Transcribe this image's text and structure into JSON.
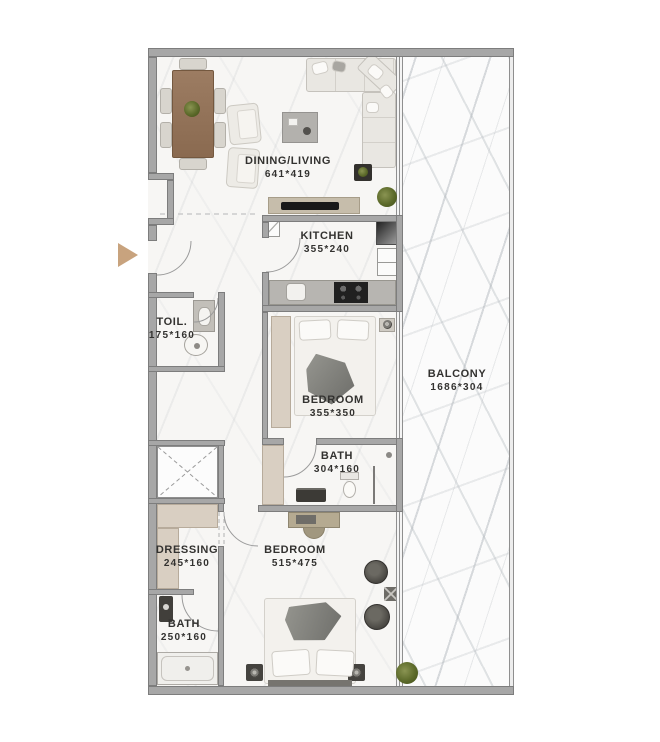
{
  "plan": {
    "rooms": [
      {
        "id": "dining-living",
        "label": "DINING/LIVING",
        "dims": "641*419"
      },
      {
        "id": "kitchen",
        "label": "KITCHEN",
        "dims": "355*240"
      },
      {
        "id": "toilet",
        "label": "TOIL.",
        "dims": "175*160"
      },
      {
        "id": "bedroom-1",
        "label": "BEDROOM",
        "dims": "355*350"
      },
      {
        "id": "balcony",
        "label": "BALCONY",
        "dims": "1686*304"
      },
      {
        "id": "bath-1",
        "label": "BATH",
        "dims": "304*160"
      },
      {
        "id": "dressing",
        "label": "DRESSING",
        "dims": "245*160"
      },
      {
        "id": "bedroom-2",
        "label": "BEDROOM",
        "dims": "515*475"
      },
      {
        "id": "bath-2",
        "label": "BATH",
        "dims": "250*160"
      }
    ],
    "colors": {
      "wall": "#a7a7a7",
      "wall_edge": "#7d7d7d",
      "label_text": "#333230",
      "furniture_beige": "#d9cfc2",
      "wood_table": "#96765c",
      "entrance_arrow": "#c8a37e",
      "plant_green": "#5c6a2a",
      "dark_fixture": "#35332f"
    },
    "icons": {
      "entrance_arrow": "right-arrow"
    }
  }
}
